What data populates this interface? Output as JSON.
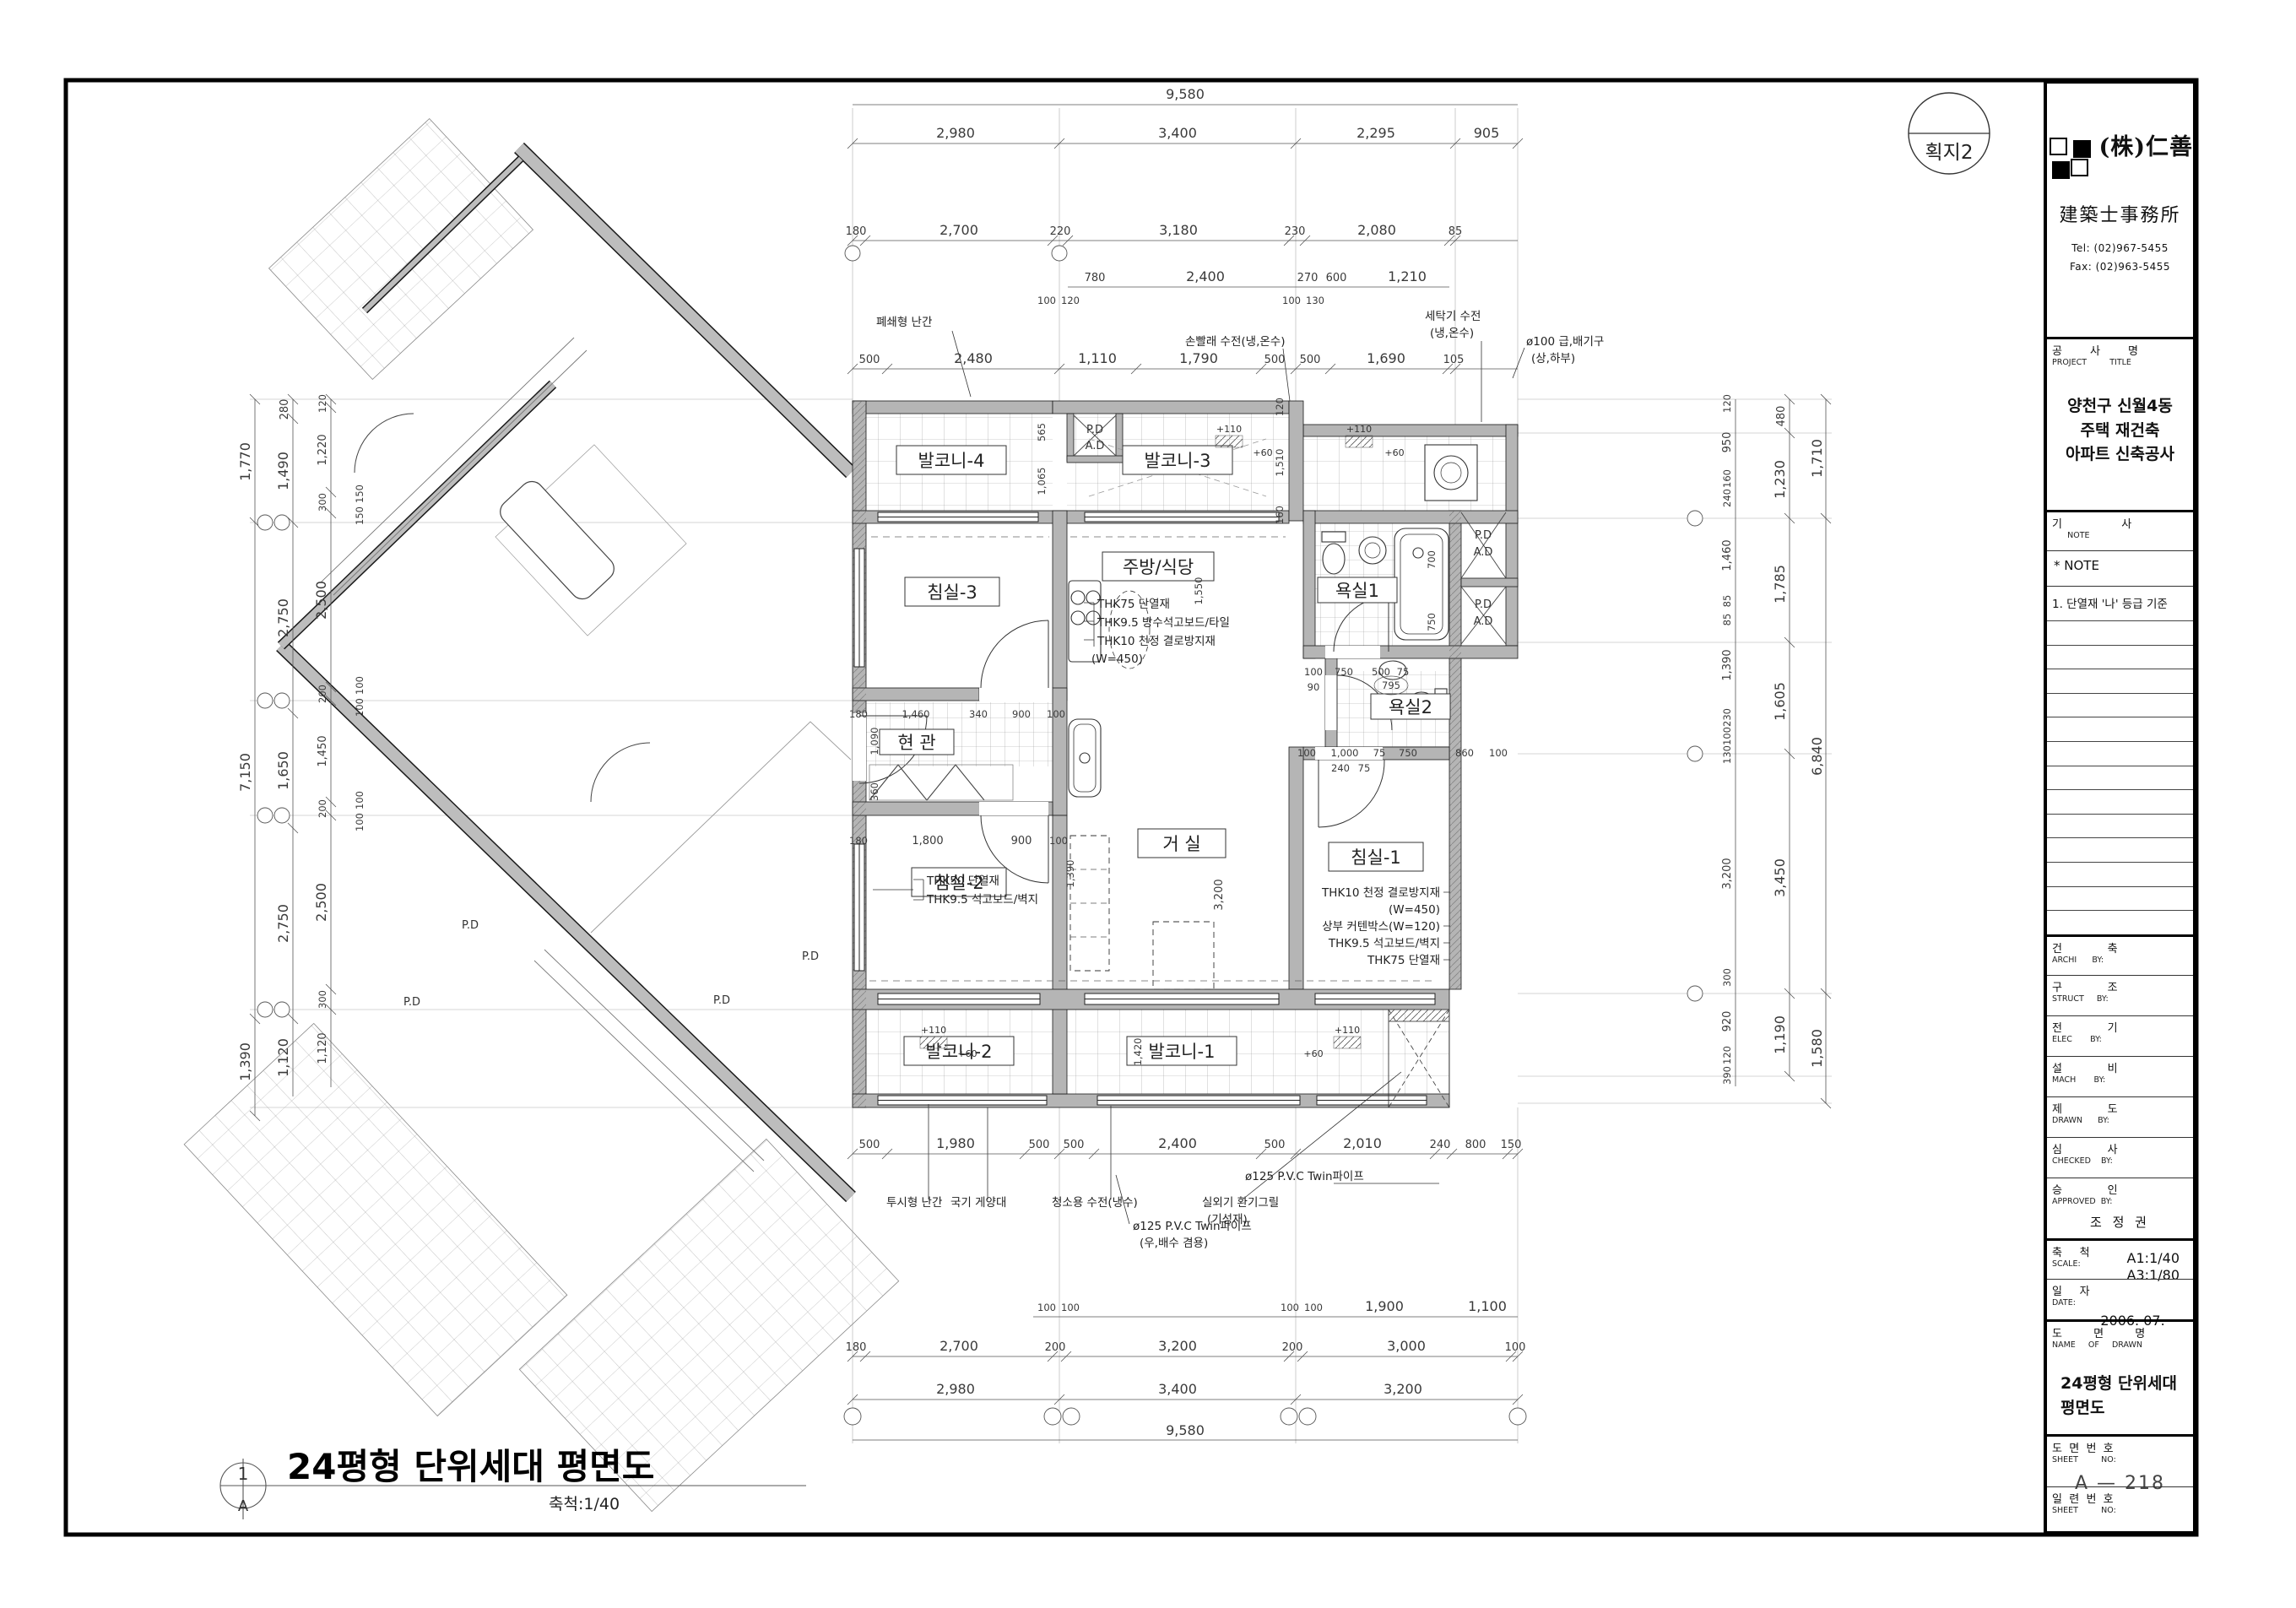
{
  "sheet": {
    "badge": "획지2"
  },
  "firm": {
    "name": "(株)仁善",
    "office": "建築士事務所",
    "tel": "Tel: (02)967-5455",
    "fax": "Fax: (02)963-5455"
  },
  "tb": {
    "project_ko": "공        사        명",
    "project_en": "PROJECT         TITLE",
    "project_name_1": "양천구 신월4동",
    "project_name_2": "주택 재건축",
    "project_name_3": "아파트 신축공사",
    "note_ko": "기                 사",
    "note_en": "      NOTE",
    "note_star": "*  NOTE",
    "note_1": "1. 단열재 '나' 등급 기준",
    "rows": [
      {
        "ko": "건             축",
        "en": "ARCHI      BY:"
      },
      {
        "ko": "구             조",
        "en": "STRUCT     BY:"
      },
      {
        "ko": "전             기",
        "en": "ELEC       BY:"
      },
      {
        "ko": "설             비",
        "en": "MACH       BY:"
      },
      {
        "ko": "제             도",
        "en": "DRAWN      BY:"
      },
      {
        "ko": "심             사",
        "en": "CHECKED    BY:"
      }
    ],
    "approved_ko": "승             인",
    "approved_en": "APPROVED  BY:",
    "approved_name": "조  정  권",
    "scale_ko": "축     척",
    "scale_en": "SCALE:",
    "scale_1": "A1:1/40",
    "scale_2": "A3:1/80",
    "date_ko": "일     자",
    "date_en": "DATE:",
    "date_val": "2006.  07.",
    "name_ko": "도         면         명",
    "name_en": "NAME     OF     DRAWN",
    "name_1": "24평형 단위세대",
    "name_2": "평면도",
    "sheetno_ko": "도  면  번  호",
    "sheetno_en": "SHEET         NO:",
    "sheetno_val": "A  —  218",
    "serial_ko": "일  련  번  호",
    "serial_en": "SHEET         NO:",
    "serial_val": ""
  },
  "footer": {
    "num": "1",
    "letter": "A",
    "title": "24평형 단위세대 평면도",
    "scale": "축척:1/40"
  },
  "plan": {
    "rooms": {
      "balc4": "발코니-4",
      "balc3": "발코니-3",
      "bed3": "침실-3",
      "kitchen": "주방/식당",
      "bath1": "욕실1",
      "bath2": "욕실2",
      "hall": "현 관",
      "living": "거 실",
      "bed1": "침실-1",
      "bed2": "침실-2",
      "balc2": "발코니-2",
      "balc1": "발코니-1"
    },
    "shaft": {
      "pd": "P.D",
      "ad": "A.D"
    },
    "notes": {
      "kitchen": [
        "THK75 단열재",
        "THK9.5 방수석고보드/타일",
        "THK10 천정 결로방지재",
        "(W=450)"
      ],
      "bed1": [
        "THK10 천정 결로방지재",
        "(W=450)",
        "상부 커텐박스(W=120)",
        "THK9.5 석고보드/벽지",
        "THK75 단열재"
      ],
      "bed2": [
        "THK50 단열재",
        "THK9.5 석고보드/벽지"
      ],
      "rail_top": "폐쇄형 난간",
      "hand_wash": "손빨래 수전(냉,온수)",
      "washer_1": "세탁기 수전",
      "washer_2": "(냉,온수)",
      "vent_1": "ø100 급,배기구",
      "vent_2": "(상,하부)",
      "rail_bot": "투시형 난간",
      "flag": "국기 게양대",
      "clean": "청소용 수전(냉수)",
      "pvc1_1": "ø125 P.V.C Twin파이프",
      "pvc1_2": "(우,배수 겸용)",
      "grille_1": "실외기 환기그릴",
      "grille_2": "(기성재)",
      "pvc2": "ø125 P.V.C Twin파이프"
    },
    "levels": {
      "p110": "+110",
      "p60": "+60"
    },
    "dims": {
      "top": {
        "r1": [
          "9,580"
        ],
        "r2": [
          "2,980",
          "3,400",
          "2,295",
          "905"
        ],
        "r3": [
          "180",
          "2,700",
          "220",
          "3,180",
          "230",
          "2,080",
          "85"
        ],
        "r4": [
          "780",
          "2,400",
          "270",
          "600",
          "1,210"
        ],
        "r4s": [
          "100",
          "120",
          "100",
          "130"
        ],
        "r5": [
          "500",
          "2,480",
          "1,110",
          "1,790",
          "500",
          "500",
          "1,690",
          "105"
        ]
      },
      "bottom": {
        "r1": [
          "500",
          "1,980",
          "500",
          "500",
          "2,400",
          "500",
          "2,010",
          "240",
          "800",
          "150"
        ],
        "r2": [
          "100",
          "100",
          "100",
          "100",
          "1,900",
          "1,100"
        ],
        "r3": [
          "180",
          "2,700",
          "200",
          "3,200",
          "200",
          "3,000",
          "100"
        ],
        "r4": [
          "2,980",
          "3,400",
          "3,200"
        ],
        "r5": [
          "9,580"
        ]
      },
      "left": {
        "c1": [
          "1,770",
          "7,150",
          "1,390"
        ],
        "c2": [
          "280",
          "1,490",
          "2,750",
          "1,650",
          "2,750",
          "1,120"
        ],
        "c3": [
          "120",
          "1,220",
          "300",
          "2,500",
          "200",
          "1,450",
          "200",
          "2,500",
          "300",
          "1,120"
        ],
        "c4": [
          "150",
          "150",
          "100",
          "100",
          "100",
          "100"
        ]
      },
      "right": {
        "c1": [
          "120",
          "950",
          "160",
          "240",
          "1,460",
          "85",
          "85",
          "1,390",
          "230",
          "100",
          "130",
          "3,200",
          "300",
          "920",
          "120",
          "390"
        ],
        "c2": [
          "480",
          "1,230",
          "1,785",
          "1,605",
          "3,450",
          "1,190"
        ],
        "c3": [
          "1,710",
          "6,840",
          "1,580"
        ]
      },
      "inner": {
        "balc4_a": "565",
        "balc4_b": "1,065",
        "balc3_a": "120",
        "balc3_b": "1,510",
        "balc3_c": "160",
        "kit_a": "1,550",
        "kit_b": "1,390",
        "bath1_a": "700",
        "bath1_b": "750",
        "bath2_row": [
          "100",
          "750",
          "500",
          "75"
        ],
        "bath2_c": "795",
        "bath2_d": "90",
        "bed1_row": [
          "100",
          "1,000",
          "75",
          "750",
          "860",
          "100"
        ],
        "bed1_b": [
          "240",
          "75"
        ],
        "hall_row": [
          "180",
          "1,460",
          "340",
          "900",
          "100"
        ],
        "hall_col": [
          "1,090",
          "360"
        ],
        "bed2_row": [
          "180",
          "1,800",
          "900",
          "100"
        ],
        "liv_a": "3,200",
        "balc1_a": "1,420"
      }
    }
  }
}
